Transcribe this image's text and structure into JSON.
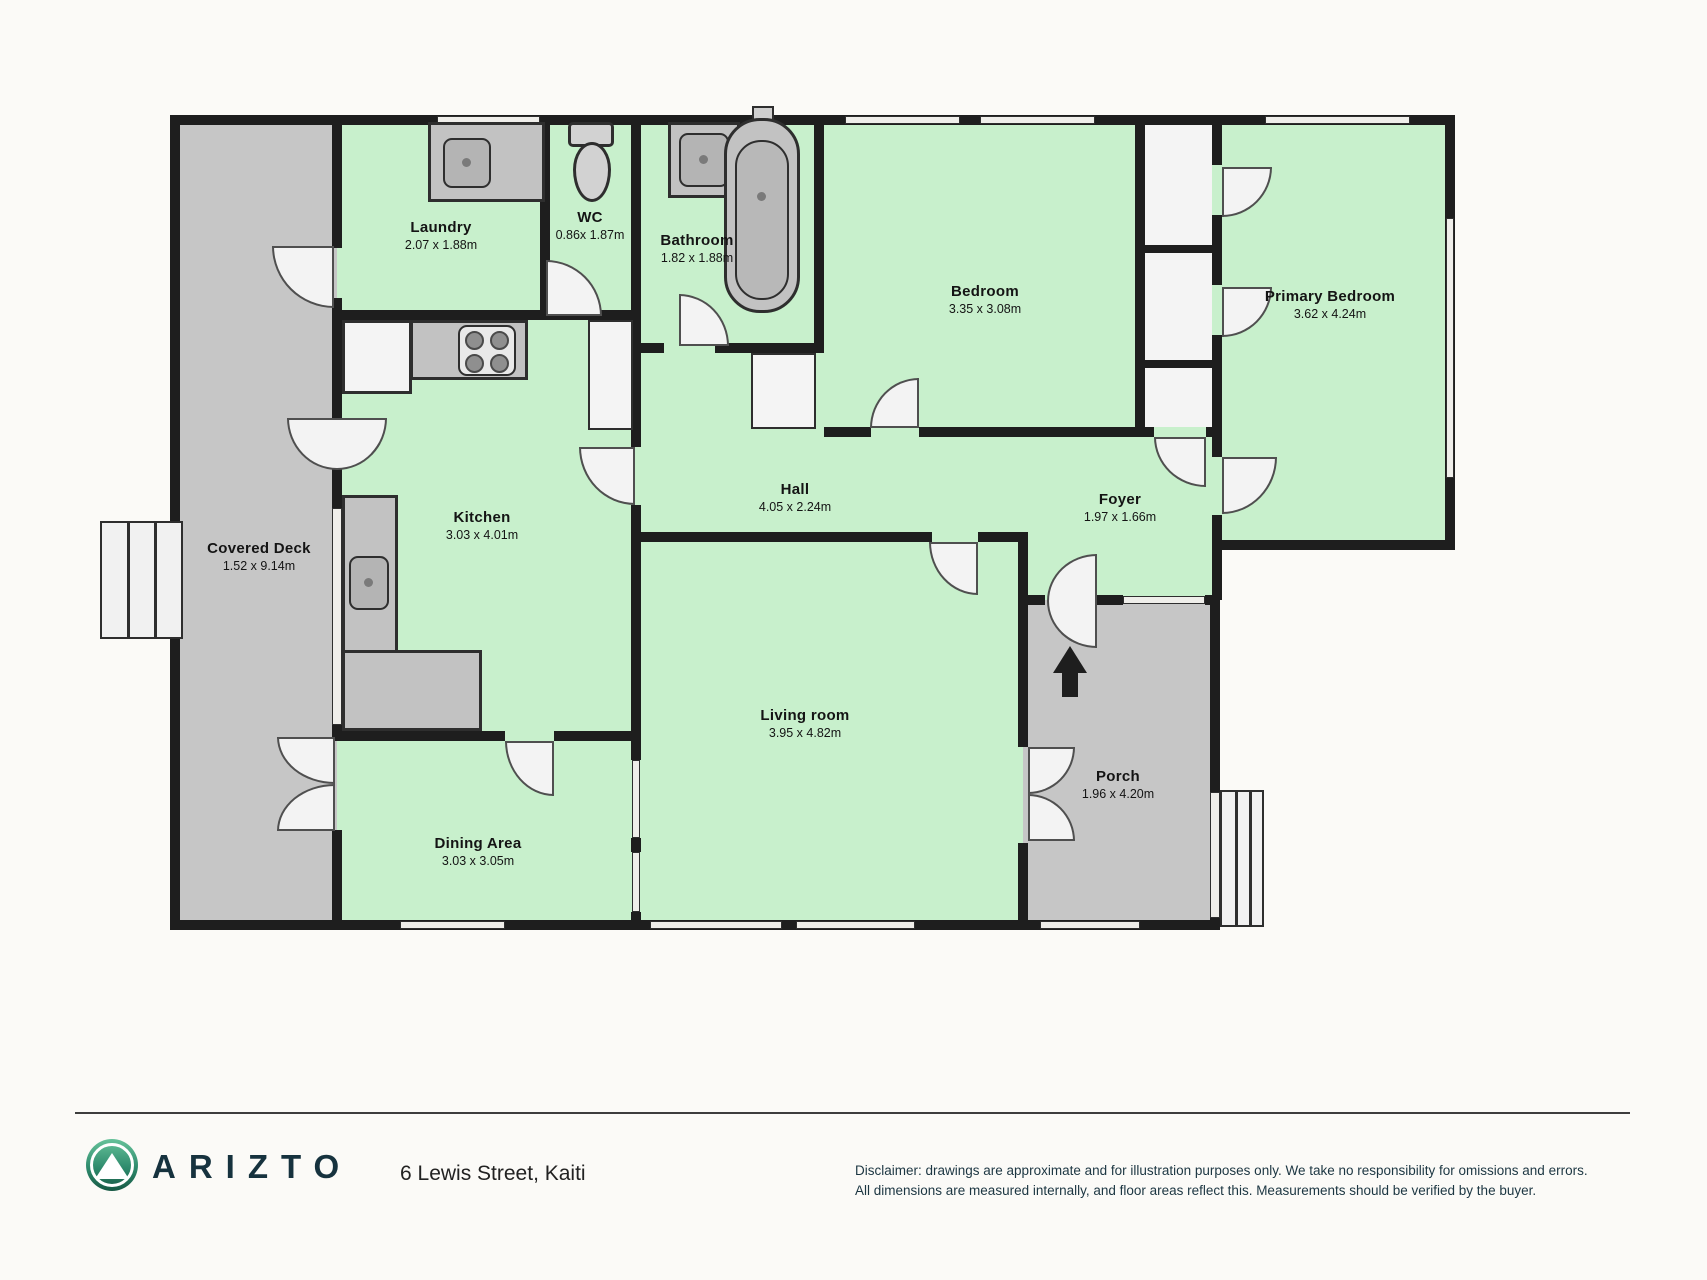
{
  "plan": {
    "colors": {
      "room_green": "#c8f0cc",
      "deck_gray": "#c6c6c6",
      "wall": "#1e1e1e",
      "fixture_gray": "#c2c2c2",
      "logo_green_top": "#66c29a",
      "logo_green_bottom": "#175844",
      "brand_navy": "#16323e"
    },
    "rooms": [
      {
        "name": "Covered Deck",
        "dims": "1.52 x 9.14m"
      },
      {
        "name": "Laundry",
        "dims": "2.07 x 1.88m"
      },
      {
        "name": "WC",
        "dims": "0.86x 1.87m"
      },
      {
        "name": "Bathroom",
        "dims": "1.82 x 1.88m"
      },
      {
        "name": "Bedroom",
        "dims": "3.35 x 3.08m"
      },
      {
        "name": "Primary Bedroom",
        "dims": "3.62 x 4.24m"
      },
      {
        "name": "Hall",
        "dims": "4.05 x 2.24m"
      },
      {
        "name": "Foyer",
        "dims": "1.97 x 1.66m"
      },
      {
        "name": "Kitchen",
        "dims": "3.03 x 4.01m"
      },
      {
        "name": "Dining Area",
        "dims": "3.03 x 3.05m"
      },
      {
        "name": "Living room",
        "dims": "3.95 x 4.82m"
      },
      {
        "name": "Porch",
        "dims": "1.96 x 4.20m"
      }
    ],
    "icons": {
      "entry_arrow": "entry direction arrow"
    }
  },
  "footer": {
    "brand": "ARIZTO",
    "address": "6 Lewis Street, Kaiti",
    "disclaimer_line1": "Disclaimer: drawings are approximate and for illustration purposes only. We take no responsibility for omissions and errors.",
    "disclaimer_line2": "All dimensions are measured internally, and floor areas reflect this. Measurements should be verified by the buyer."
  }
}
